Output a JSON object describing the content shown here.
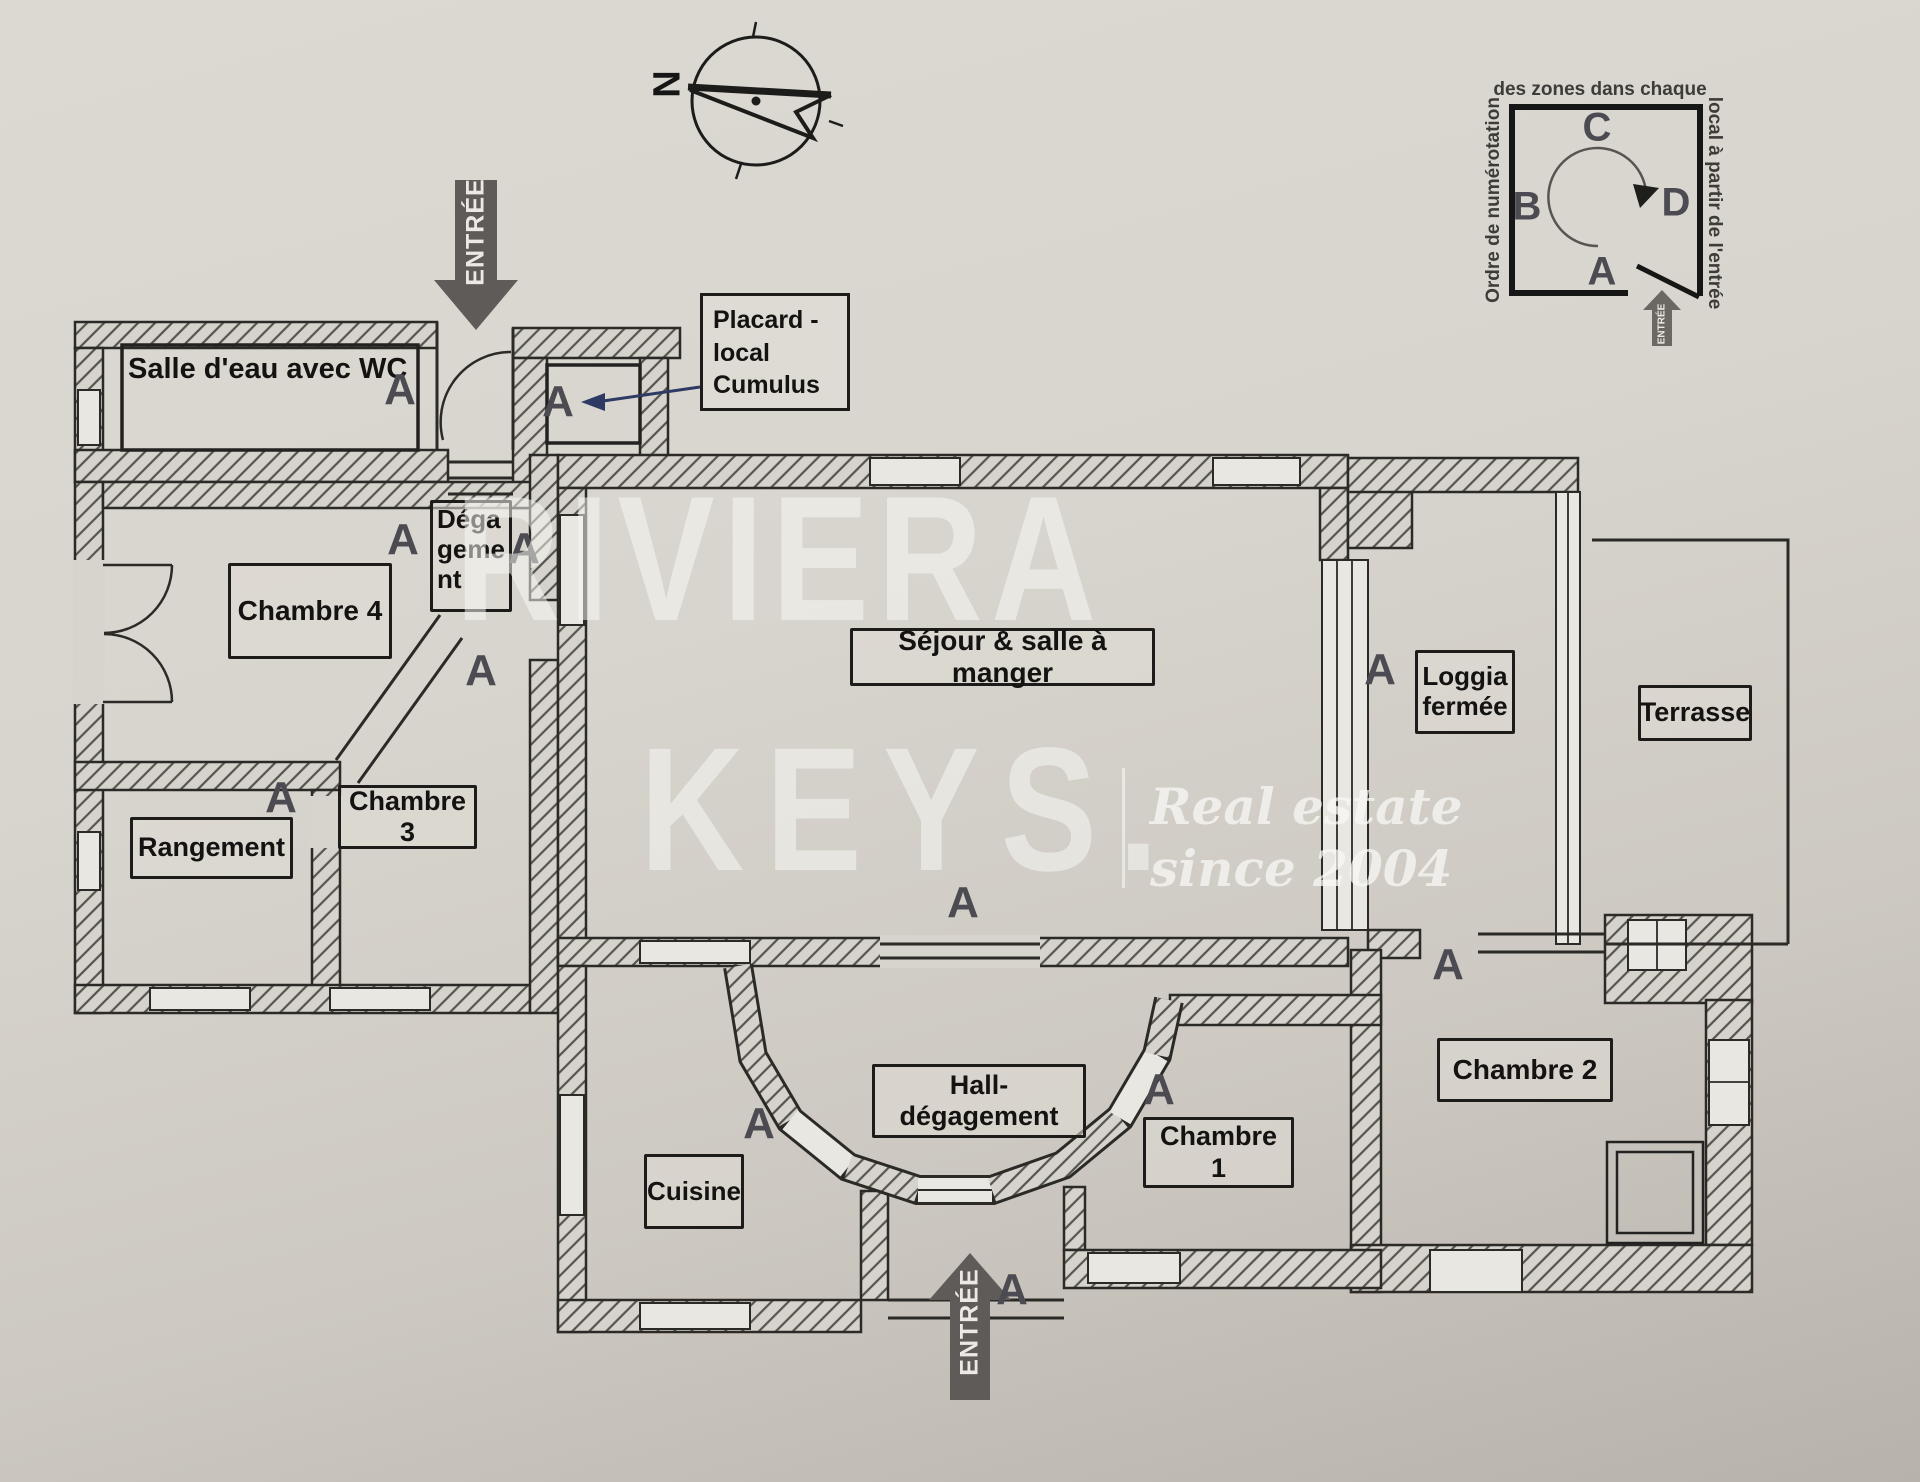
{
  "watermark": {
    "brand_line1": "RIVIERA",
    "brand_line2": "KEYS.",
    "tagline_line1": "Real estate",
    "tagline_line2": "since 2004"
  },
  "compass": {
    "north_label": "N"
  },
  "legend": {
    "caption_top": "des zones dans chaque",
    "caption_left": "Ordre de numérotation",
    "caption_right": "local à partir de l'entrée",
    "zone_a": "A",
    "zone_b": "B",
    "zone_c": "C",
    "zone_d": "D",
    "entry_label": "ENTRÉE"
  },
  "entrances": {
    "top_label": "ENTRÉE",
    "bottom_label": "ENTRÉE"
  },
  "zone_marker": "A",
  "rooms": {
    "salle_eau": "Salle d'eau avec WC",
    "chambre_4": "Chambre 4",
    "degagement": "Dégagement",
    "rangement": "Rangement",
    "chambre_3": "Chambre 3",
    "sejour": "Séjour & salle à manger",
    "loggia": "Loggia fermée",
    "terrasse": "Terrasse",
    "chambre_2": "Chambre 2",
    "chambre_1": "Chambre 1",
    "hall": "Hall-dégagement",
    "cuisine": "Cuisine"
  },
  "annotations": {
    "placard": "Placard - local Cumulus"
  }
}
